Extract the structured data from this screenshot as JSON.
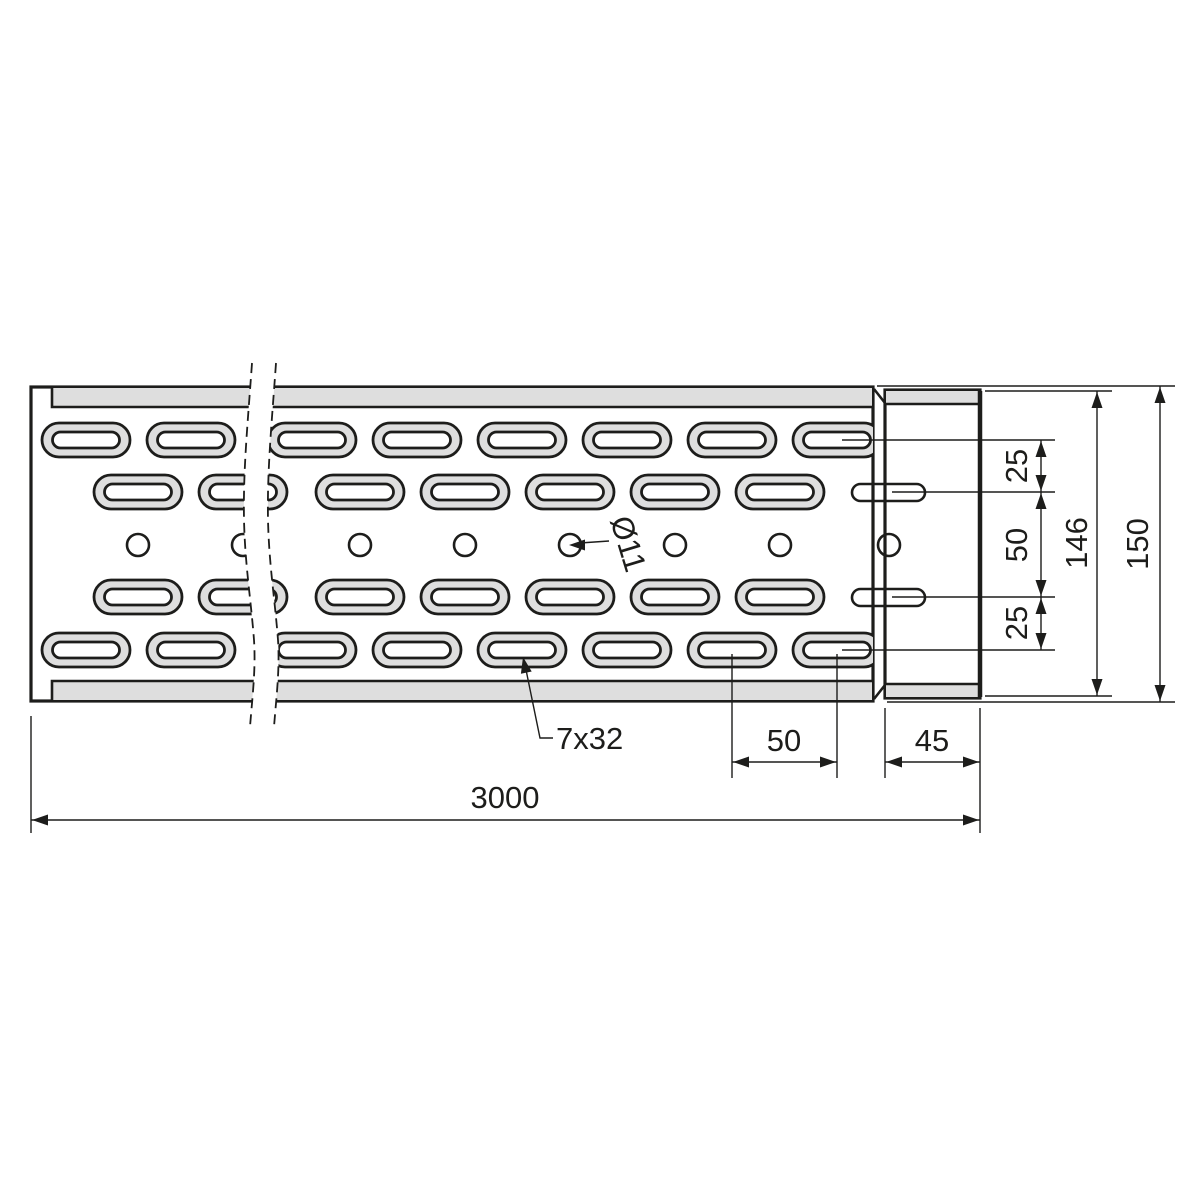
{
  "drawing": {
    "dims": {
      "offset_top": "25",
      "spacing_mid": "50",
      "offset_bottom": "25",
      "height_inner": "146",
      "height_outer": "150",
      "slot_pitch": "50",
      "end_width": "45",
      "total_length": "3000"
    },
    "labels": {
      "slot_size": "7x32",
      "hole_dia": "Ø11"
    },
    "colors": {
      "line": "#1d1d1b",
      "floor": "#ececec",
      "emboss": "#dedede",
      "hole_fill": "#ffffff",
      "background": "#ffffff"
    }
  }
}
